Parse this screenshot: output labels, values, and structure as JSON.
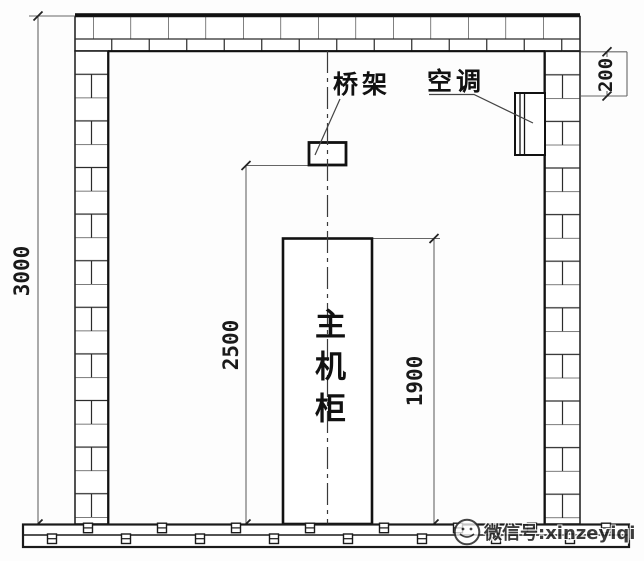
{
  "diagram": {
    "labels": {
      "cable_tray": "桥架",
      "air_conditioner": "空调",
      "main_cabinet": "主机柜"
    },
    "dimensions": {
      "room_height": "3000",
      "cable_tray_height": "2500",
      "cabinet_height": "1900",
      "ac_clearance": "200"
    },
    "watermark": {
      "icon": "wechat-logo-icon",
      "text": "微信号:xinzeyiqi"
    },
    "colors": {
      "wall_line": "#1a1a1a",
      "dim_line": "#666666",
      "background": "#fdfdfd",
      "text": "#111111",
      "watermark_text": "#222222"
    }
  }
}
